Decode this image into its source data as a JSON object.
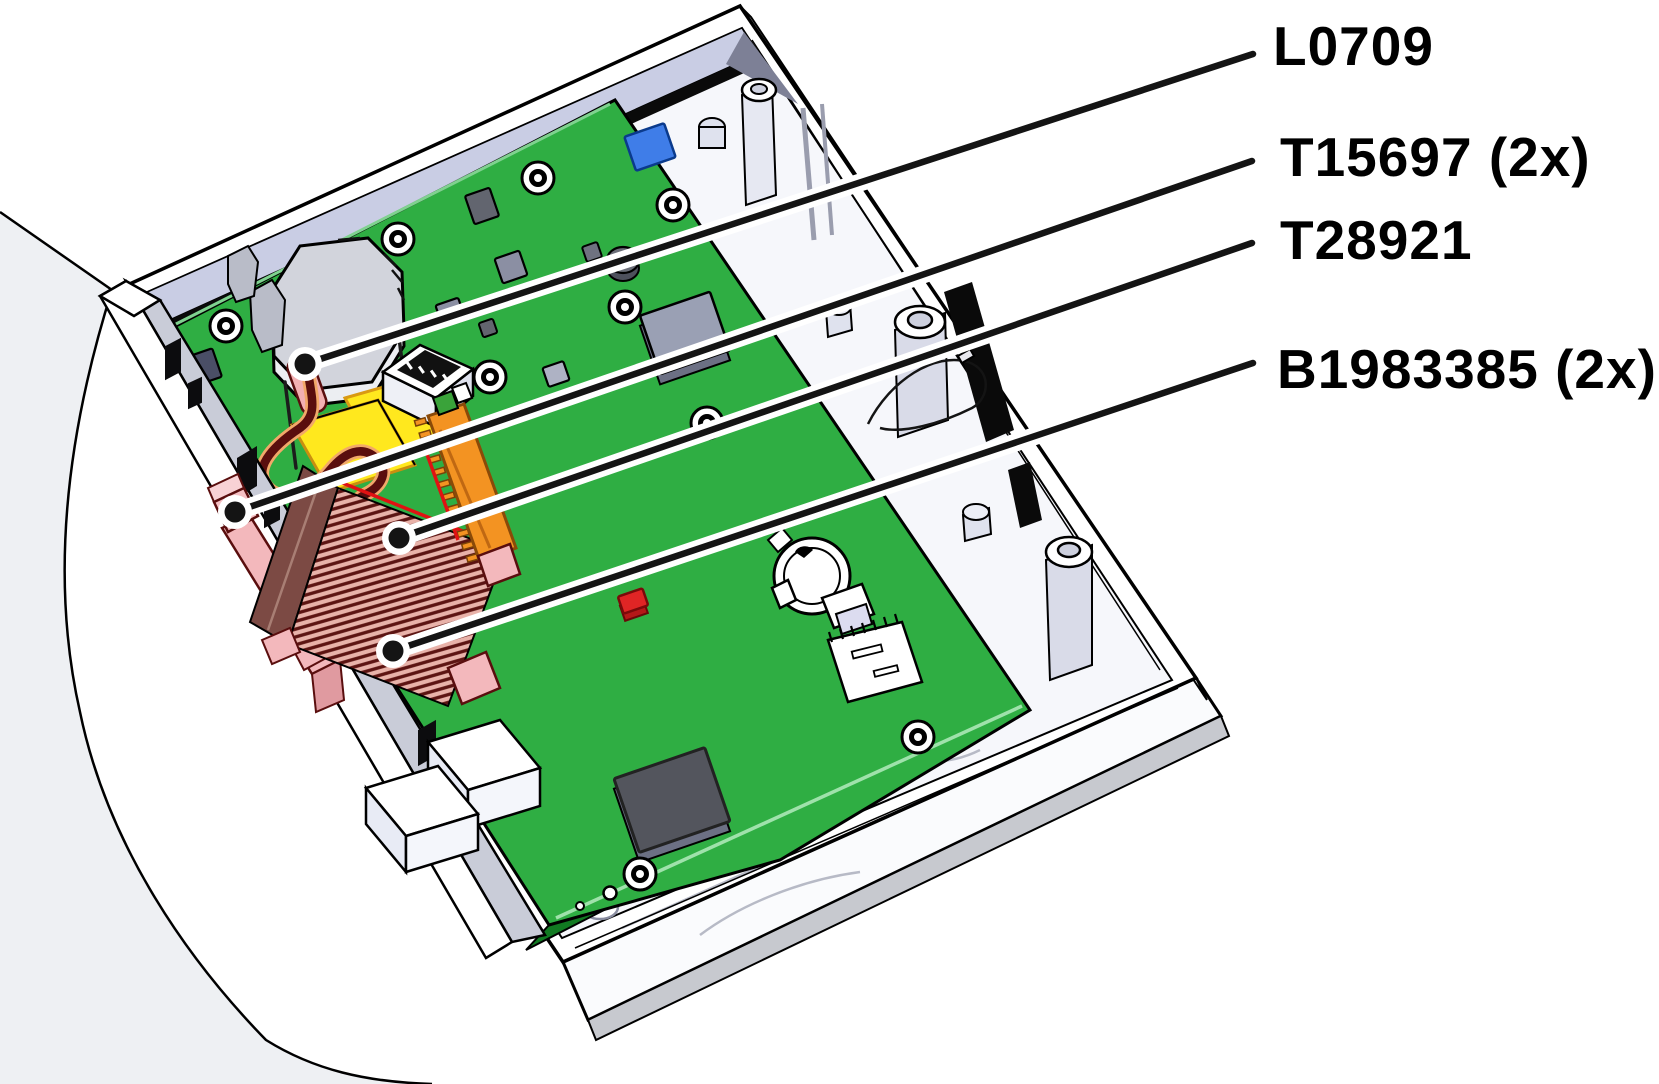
{
  "figure": {
    "type": "hardware-parts-callout-diagram",
    "description_labels": [
      "L0709",
      "T15697 (2x)",
      "T28921",
      "B1983385 (2x)"
    ],
    "callouts": [
      {
        "label": "L0709",
        "line": {
          "x1": 1253,
          "y1": 54,
          "x2": 305,
          "y2": 364
        },
        "label_x": 1273,
        "label_y": 46
      },
      {
        "label": "T15697 (2x)",
        "line": {
          "x1": 1252,
          "y1": 161,
          "x2": 235,
          "y2": 512
        },
        "label_x": 1280,
        "label_y": 157
      },
      {
        "label": "T28921",
        "line": {
          "x1": 1252,
          "y1": 243,
          "x2": 399,
          "y2": 538
        },
        "label_x": 1280,
        "label_y": 240
      },
      {
        "label": "B1983385 (2x)",
        "line": {
          "x1": 1253,
          "y1": 363,
          "x2": 393,
          "y2": 651
        },
        "label_x": 1277,
        "label_y": 369
      }
    ],
    "colors": {
      "background": "#ffffff",
      "pcb_green": "#2fae43",
      "pcb_green_dark": "#117a22",
      "pcb_green_light": "#9fe2ab",
      "case_white": "#ffffff",
      "case_floor": "#f6f7fb",
      "case_lavender": "#c9cde4",
      "case_gray": "#c7c9cf",
      "outline": "#000000",
      "wire_maroon": "#5a0e0e",
      "wire_halo": "#f2a869",
      "ribbon_pink": "#e8b2a9",
      "ribbon_maroon": "#7c4a44",
      "connector_pink": "#f3b8bc",
      "cap_yellow": "#ffe81e",
      "connector_orange": "#f39322",
      "chip_blue": "#3f7de8",
      "switch_red": "#e02525",
      "chip_dark": "#53555d",
      "chip_medium": "#9aa0b4",
      "leader": "#141414"
    }
  }
}
